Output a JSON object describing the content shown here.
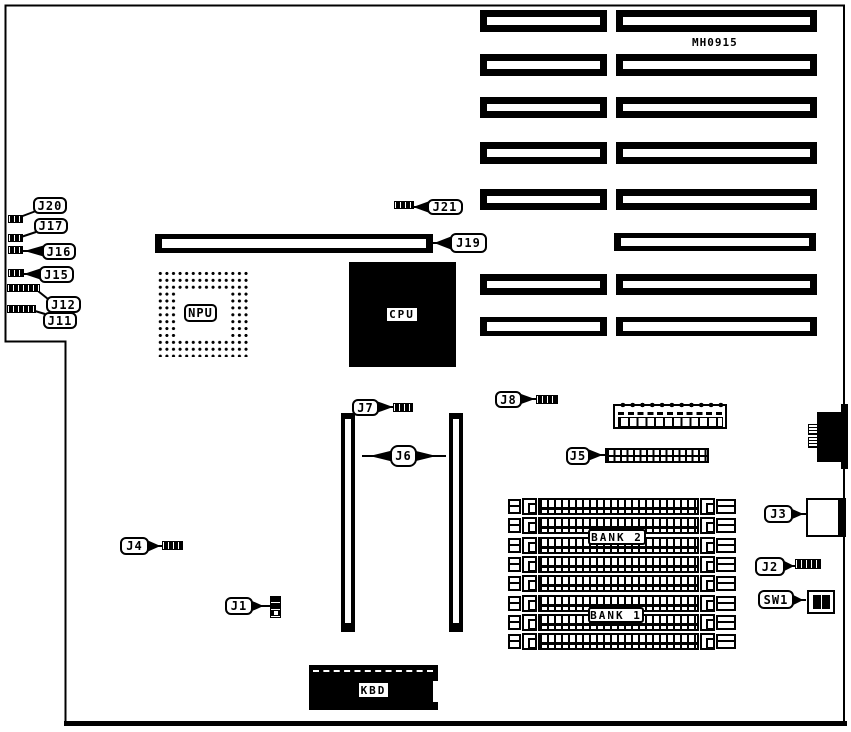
{
  "diagram": {
    "part_number": "MH0915",
    "chips": {
      "npu": "NPU",
      "cpu": "CPU",
      "kbd": "KBD"
    },
    "memory": {
      "bank1": "BANK 1",
      "bank2": "BANK 2"
    },
    "callouts": {
      "j1": "J1",
      "j2": "J2",
      "j3": "J3",
      "j4": "J4",
      "j5": "J5",
      "j6": "J6",
      "j7": "J7",
      "j8": "J8",
      "j11": "J11",
      "j12": "J12",
      "j15": "J15",
      "j16": "J16",
      "j17": "J17",
      "j19": "J19",
      "j20": "J20",
      "j21": "J21",
      "sw1": "SW1"
    },
    "colors": {
      "ink": "#000000",
      "paper": "#ffffff"
    }
  }
}
